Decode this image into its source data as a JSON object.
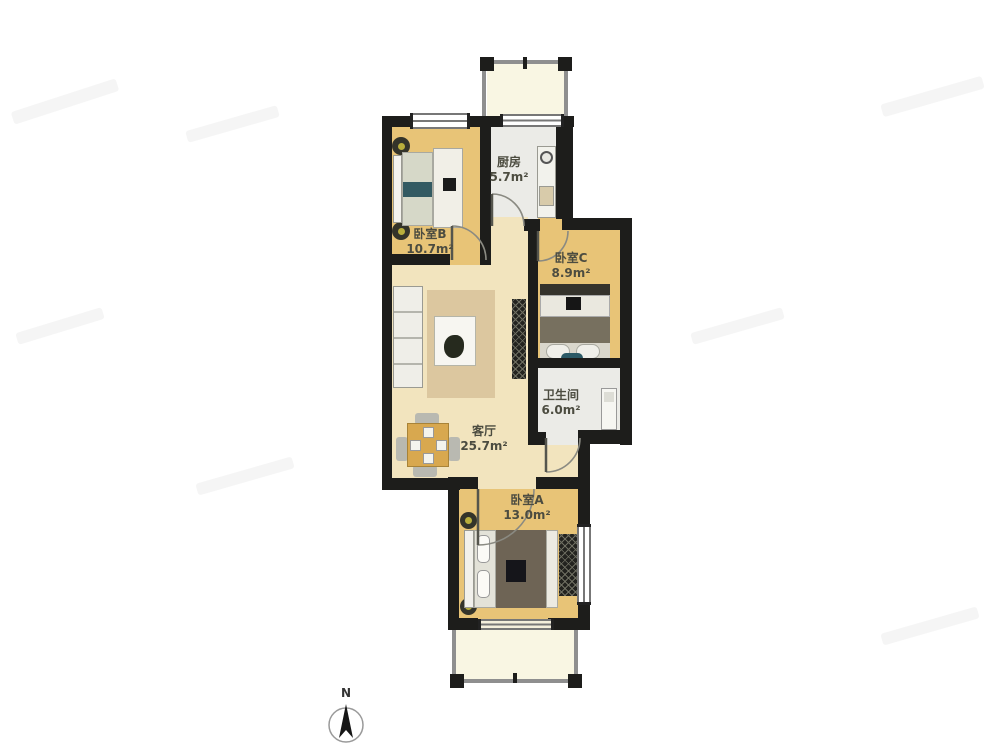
{
  "plan": {
    "rooms": [
      {
        "name": "厨房",
        "area": "5.7m²"
      },
      {
        "name": "卧室B",
        "area": "10.7m²"
      },
      {
        "name": "卧室C",
        "area": "8.9m²"
      },
      {
        "name": "卫生间",
        "area": "6.0m²"
      },
      {
        "name": "客厅",
        "area": "25.7m²"
      },
      {
        "name": "卧室A",
        "area": "13.0m²"
      }
    ],
    "compass": {
      "label": "N"
    },
    "colors": {
      "wall": "#1d1d1b",
      "wood_floor": "#e8c477",
      "living_floor": "#f2e4be",
      "tile_floor": "#ebebe7",
      "balcony_floor": "#f9f6e3",
      "rug": "#dcc79f",
      "blanket_dark": "#6e6455",
      "accent_teal": "#2c5a66"
    }
  }
}
